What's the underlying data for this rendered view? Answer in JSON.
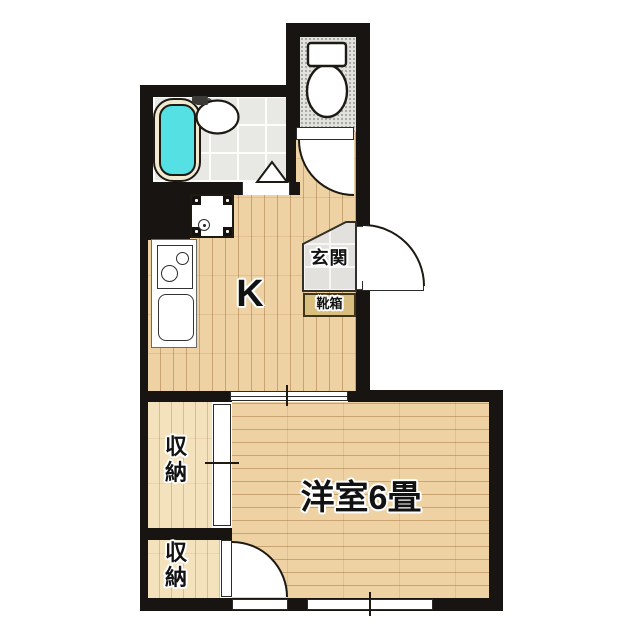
{
  "plan": {
    "title": "1K apartment floor plan",
    "labels": {
      "kitchen": "K",
      "entrance": "玄関",
      "shoe_box": "靴箱",
      "storage_top": "収納",
      "storage_bottom": "収納",
      "main_room": "洋室6畳"
    },
    "rooms": [
      {
        "name": "kitchen",
        "label": "K"
      },
      {
        "name": "entrance-genkan",
        "label": "玄関"
      },
      {
        "name": "western-room-6-tatami",
        "label": "洋室6畳"
      },
      {
        "name": "storage-closet-upper",
        "label": "収納"
      },
      {
        "name": "storage-closet-lower",
        "label": "収納"
      },
      {
        "name": "bathroom",
        "label": ""
      },
      {
        "name": "toilet-room",
        "label": ""
      }
    ],
    "fixtures": [
      "toilet",
      "bathtub",
      "wash-basin",
      "washer-pan",
      "gas-stove",
      "kitchen-sink",
      "shoe-box",
      "front-door",
      "toilet-door",
      "closet-door",
      "sliding-door",
      "window",
      "bath-folding-door"
    ],
    "colors": {
      "wall": "#171412",
      "wood_floor": "#eed2a3",
      "closet_floor": "#f4e2bd",
      "bath_tile": "#e8e9e4",
      "genkan_tile": "#e2e1dd",
      "toilet_floor": "#e2e2df",
      "bathtub_water": "#55e0e3",
      "bathtub_rim": "#f1ead0",
      "shoe_box_fill": "#d8bf80",
      "background": "#ffffff"
    }
  }
}
